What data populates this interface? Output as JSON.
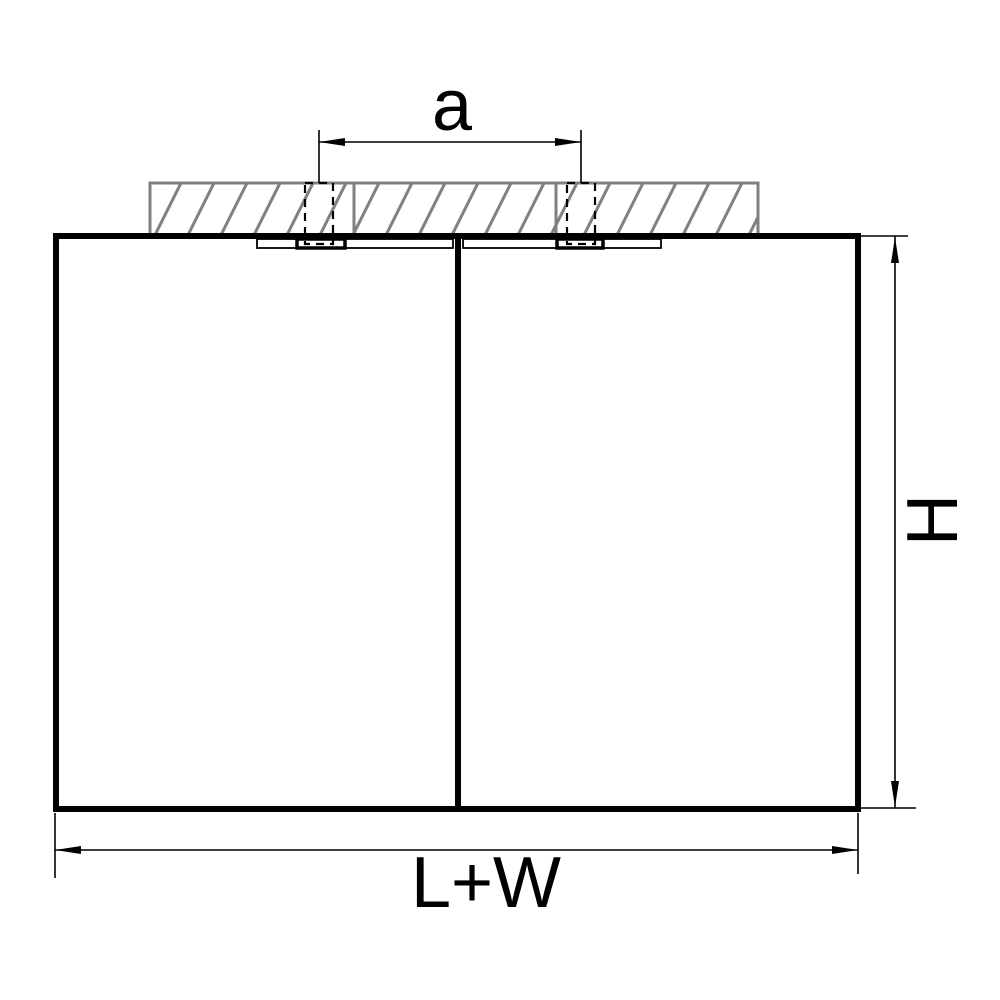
{
  "figure": {
    "type": "technical-dimension-drawing",
    "subject": "twin ceiling-mounted cube light fixture, front elevation",
    "labels": {
      "mount_spacing": "a",
      "height": "H",
      "length_width": "L+W"
    },
    "colors": {
      "line": "#000000",
      "hatch": "#808080",
      "background": "#ffffff"
    }
  }
}
